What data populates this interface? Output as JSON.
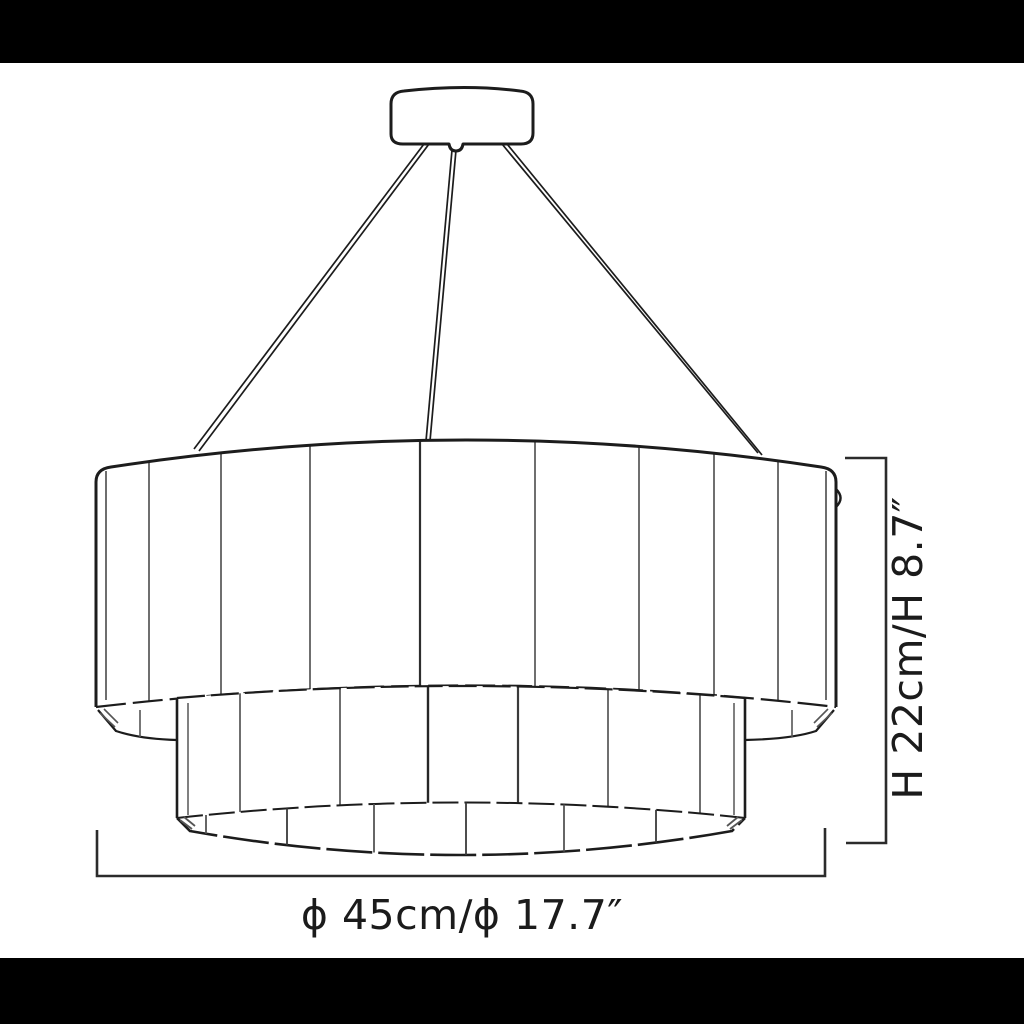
{
  "annotations": {
    "diameter_label": "ϕ 45cm/ϕ 17.7″",
    "height_label": "H 22cm/H 8.7″"
  },
  "colors": {
    "background": "#ffffff",
    "letterbox": "#000000",
    "outline": "#1c1c1c",
    "panel_line": "#6f6f6f",
    "panel_line_dark": "#2e2e2e",
    "dimension_line": "#2b2b2b",
    "text": "#1b1b1b"
  },
  "fixture": {
    "tiers": 2,
    "suspension_cables": 3,
    "upper_tier_panel_lines": 8,
    "lower_tier_panel_lines": 6
  }
}
